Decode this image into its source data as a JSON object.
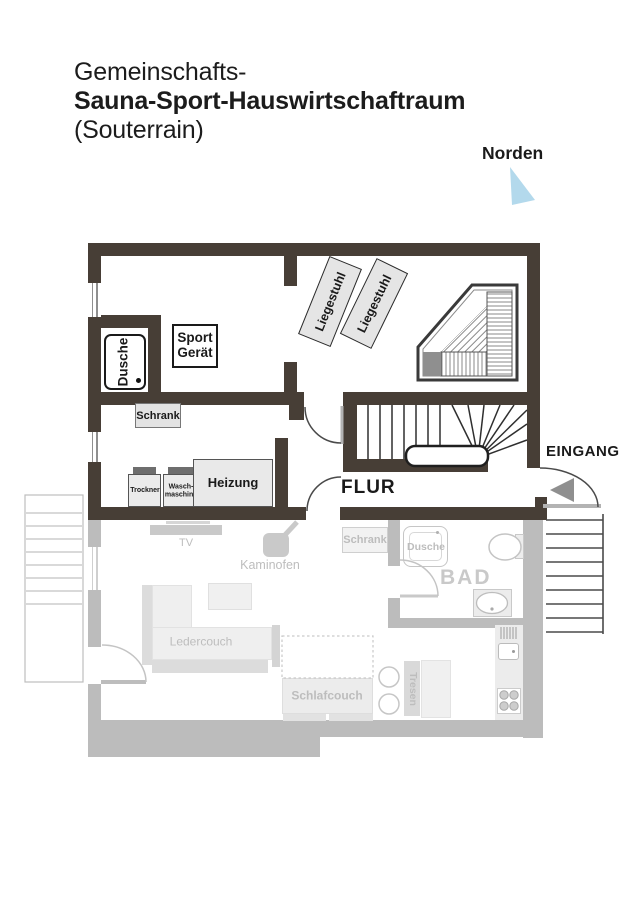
{
  "title": {
    "line1": "Gemeinschafts-",
    "line2": "Sauna-Sport-Hauswirtschaftraum",
    "line3": "(Souterrain)"
  },
  "compass": {
    "label": "Norden"
  },
  "souterrain": {
    "rooms": {
      "flur": "FLUR",
      "eingang": "EINGANG"
    },
    "furniture": {
      "dusche": "Dusche",
      "sport_geraet": [
        "Sport",
        "Gerät"
      ],
      "schrank": "Schrank",
      "trockner": "Trockner",
      "waschmaschine": [
        "Wasch-",
        "maschine"
      ],
      "heizung": "Heizung",
      "liegestuhl": [
        "Liegestuhl",
        "Liegestuhl"
      ],
      "sauna": "Sauna"
    }
  },
  "ground_floor": {
    "rooms": {
      "bad": "BAD"
    },
    "furniture": {
      "tv": "TV",
      "kaminofen": "Kaminofen",
      "schrank": "Schrank",
      "dusche": "Dusche",
      "wc": "WC",
      "ledercouch": "Ledercouch",
      "schlafcouch": "Schlafcouch",
      "tresen": "Tresen"
    }
  },
  "colors": {
    "wall-dark": "#473E36",
    "wall-gray": "#bcbcbc",
    "north-blue": "#b3d9ec",
    "label-gray": "#bdbdbd",
    "ink": "#1a1a1a"
  }
}
